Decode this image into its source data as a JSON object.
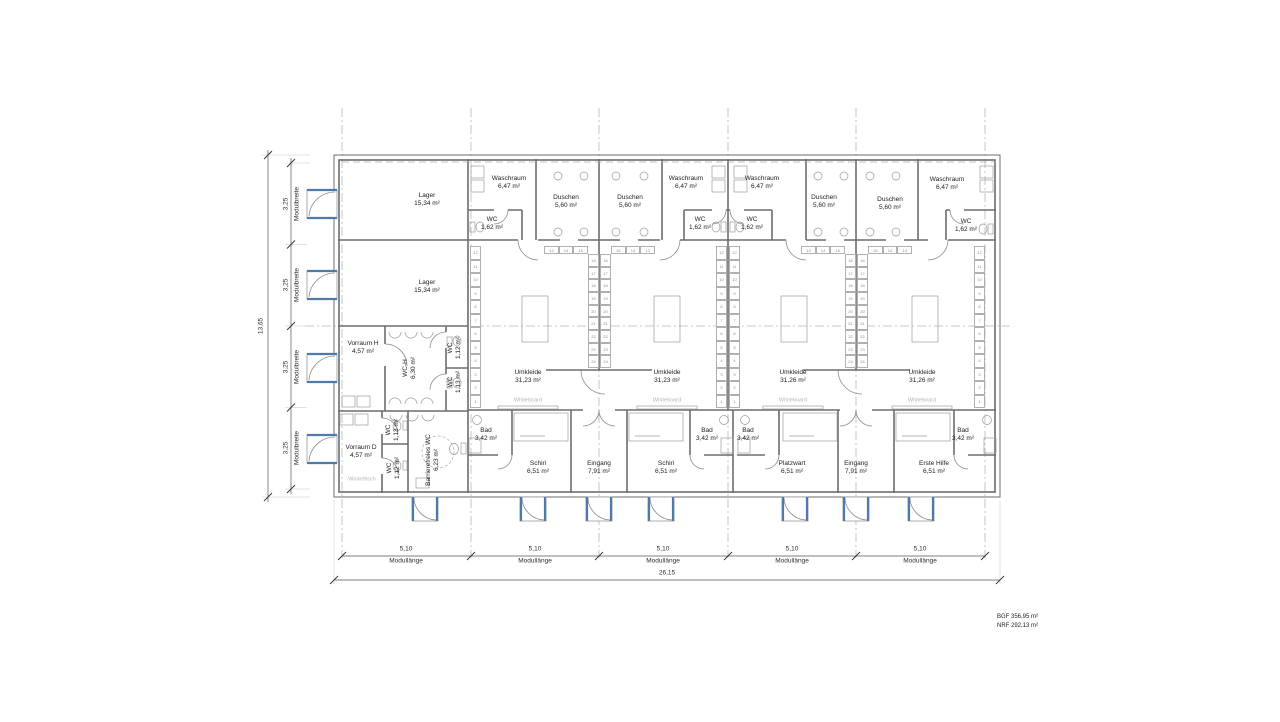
{
  "plan": {
    "rooms": {
      "lager": {
        "name": "Lager",
        "area": "15,34 m²"
      },
      "waschraum": {
        "name": "Waschraum",
        "area": "6,47 m²"
      },
      "duschen": {
        "name": "Duschen",
        "area": "5,60 m²"
      },
      "wc_klein": {
        "name": "WC",
        "area": "1,62 m²"
      },
      "umkleide_a": {
        "name": "Umkleide",
        "area": "31,23 m²"
      },
      "umkleide_b": {
        "name": "Umkleide",
        "area": "31,26 m²"
      },
      "bad": {
        "name": "Bad",
        "area": "3,42 m²"
      },
      "schiri": {
        "name": "Schiri",
        "area": "6,51 m²"
      },
      "eingang": {
        "name": "Eingang",
        "area": "7,91 m²"
      },
      "platzwart": {
        "name": "Platzwart",
        "area": "6,51 m²"
      },
      "erste_hilfe": {
        "name": "Erste Hilfe",
        "area": "6,51 m²"
      },
      "vorraum_h": {
        "name": "Vorraum H",
        "area": "4,57 m²"
      },
      "vorraum_d": {
        "name": "Vorraum D",
        "area": "4,57 m²"
      },
      "wc_h": {
        "name": "WC-H",
        "area": "6,30 m²"
      },
      "wc_112": {
        "name": "WC",
        "area": "1,12 m²"
      },
      "wc_113": {
        "name": "WC",
        "area": "1,13 m²"
      },
      "barrierefrei": {
        "name": "Barrierefreies WC",
        "area": "6,23 m²"
      }
    },
    "annotations": {
      "whiteboard": "Whiteboard",
      "wickeltisch": "Wickeltisch"
    },
    "lockers": {
      "header": [
        "13",
        "14",
        "15"
      ],
      "header_rev": [
        "15",
        "14",
        "13"
      ],
      "column": [
        "16",
        "17",
        "18",
        "19",
        "20",
        "21",
        "22",
        "23",
        "24"
      ],
      "side": [
        "12",
        "11",
        "10",
        "9",
        "8",
        "7",
        "6",
        "5",
        "4",
        "3",
        "2",
        "1"
      ]
    },
    "dimensions": {
      "left": {
        "total": "13,65",
        "module_value": "3,25",
        "module_label": "Modulbreite"
      },
      "bottom": {
        "total": "26,15",
        "module_value": "5,10",
        "module_label": "Modullänge"
      }
    },
    "summary": {
      "line1": "BGF 356,95 m²",
      "line2": "NRF 292,13 m²"
    },
    "colors": {
      "door_accent": "#4d7aa9",
      "wall": "#6d6d6d"
    }
  }
}
